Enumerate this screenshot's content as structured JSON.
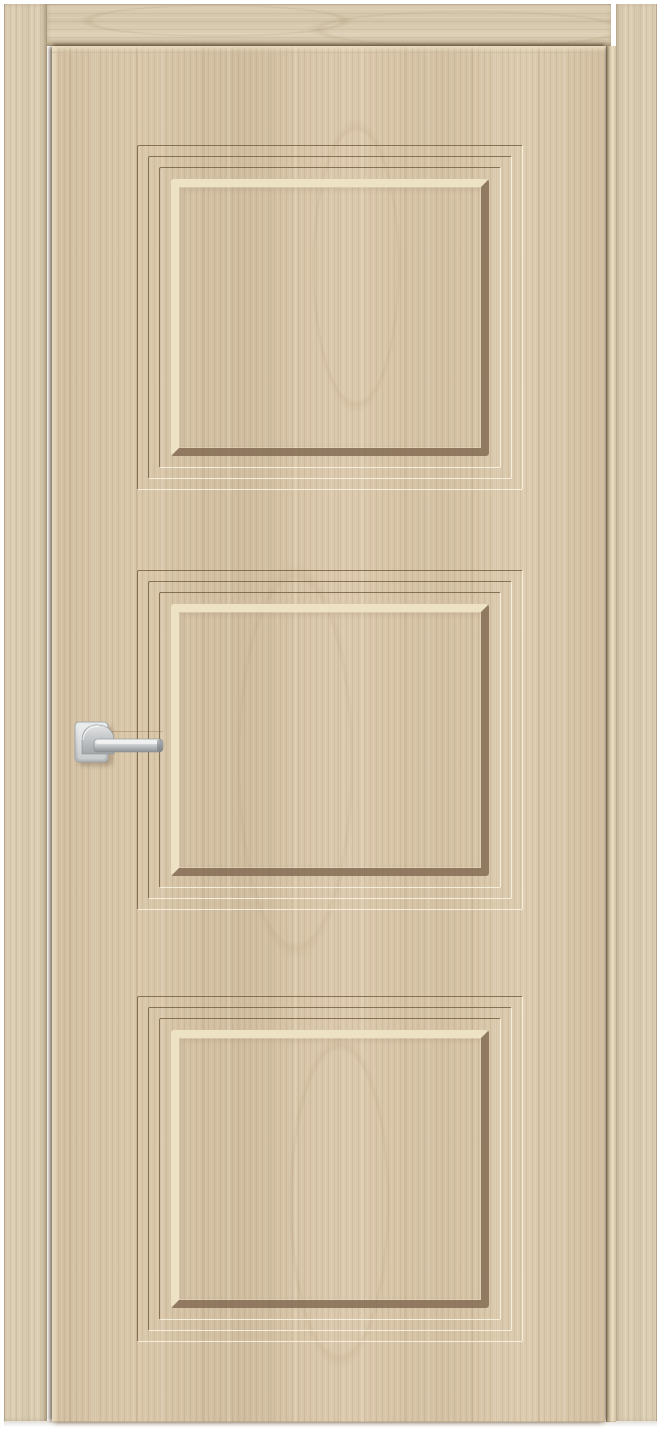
{
  "scene": {
    "type": "product photo",
    "title": "Closed interior door in frame, light oak finish, three recessed panels, chrome lever handle",
    "background": "white",
    "objects": [
      "door-frame",
      "door-leaf",
      "recessed-panels",
      "lever-handle"
    ]
  },
  "door": {
    "leaf": {
      "finish": "light oak woodgrain",
      "panel_count": 3,
      "panels": [
        {
          "position": "top",
          "style": "recessed rectangle bordered by three concentric grooves and a beveled inset"
        },
        {
          "position": "middle",
          "style": "recessed rectangle bordered by three concentric grooves and a beveled inset"
        },
        {
          "position": "bottom",
          "style": "recessed rectangle bordered by three concentric grooves and a beveled inset"
        }
      ]
    },
    "frame": {
      "parts": [
        "left jamb",
        "head jamb",
        "right jamb"
      ],
      "finish": "light oak woodgrain"
    },
    "handle": {
      "type": "lever",
      "rosette_shape": "square",
      "finish": "polished chrome",
      "mounted_side": "left",
      "lever_direction": "right"
    }
  },
  "colors": {
    "background": "#ffffff",
    "wood_base": "#d4c1a3",
    "wood_light_streak": "#e8dabd",
    "wood_dark_streak": "#c0a987",
    "frame_wood": "#d9ccb2",
    "groove_dark": "#7a6242",
    "groove_light": "#f8f0de",
    "bevel_highlight": "#eee2c5",
    "bevel_shadow": "#846d54",
    "seam_shadow": "#54432a",
    "chrome_light": "#eceeef",
    "chrome_mid": "#c3c6c8",
    "chrome_dark": "#8e9295"
  }
}
